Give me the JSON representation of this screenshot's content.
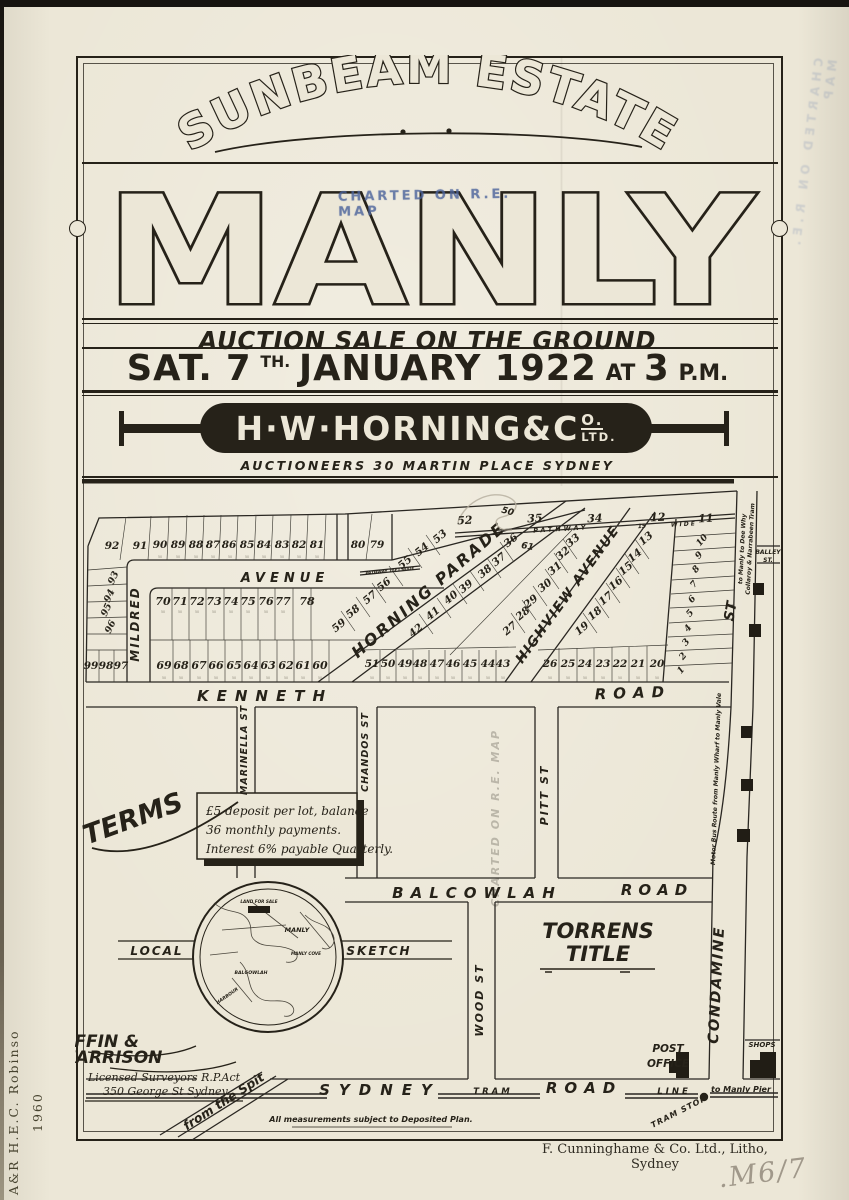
{
  "header": {
    "estate_title": "SUNBEAM ESTATE",
    "stamp": "CHARTED ON R.E. MAP",
    "place": "MANLY",
    "auction_line": "AUCTION SALE ON THE GROUND",
    "date": {
      "sat": "SAT. 7",
      "sup": "TH.",
      "rest": "JANUARY 1922",
      "at": "AT",
      "time": "3",
      "pm": "P.M."
    },
    "agent": {
      "main": "H·W·HORNING&C",
      "sup": "O.",
      "sub": "LTD.",
      "tagline": "AUCTIONEERS 30 MARTIN PLACE SYDNEY"
    }
  },
  "map": {
    "dim_label": "50",
    "lots": {
      "top_row": [
        "92",
        "91",
        "90",
        "89",
        "88",
        "87",
        "86",
        "85",
        "84",
        "83",
        "82",
        "81",
        "80",
        "79"
      ],
      "top_strip": [
        "52",
        "35",
        "34",
        "12",
        "11"
      ],
      "west_col": [
        "93",
        "94",
        "95",
        "96"
      ],
      "west_bottom": [
        "99",
        "98",
        "97"
      ],
      "mid_row_upper": [
        "70",
        "71",
        "72",
        "73",
        "74",
        "75",
        "76",
        "77",
        "78"
      ],
      "mid_row_lower": [
        "69",
        "68",
        "67",
        "66",
        "65",
        "64",
        "63",
        "62",
        "61",
        "60"
      ],
      "parade_west": [
        "53",
        "54",
        "55",
        "56",
        "57",
        "58",
        "59"
      ],
      "parade_east": [
        "36",
        "37",
        "38",
        "39",
        "40",
        "41",
        "42"
      ],
      "highview_west": [
        "33",
        "32",
        "31",
        "30",
        "29",
        "28",
        "27"
      ],
      "highview_east": [
        "13",
        "14",
        "15",
        "16",
        "17",
        "18",
        "19"
      ],
      "bottom_mid": [
        "51",
        "50",
        "49",
        "48",
        "47",
        "46",
        "45",
        "44",
        "43"
      ],
      "bottom_east": [
        "26",
        "25",
        "24",
        "23",
        "22",
        "21",
        "20"
      ],
      "east_col": [
        "10",
        "9",
        "8",
        "7",
        "6",
        "5",
        "4",
        "3",
        "2",
        "1"
      ]
    },
    "streets": {
      "mildred": "MILDRED",
      "avenue": "AVENUE",
      "horning": "HORNING PARADE",
      "highview": "HIGHVIEW AVENUE",
      "kenneth": "KENNETH",
      "kenneth_road": "ROAD",
      "pathway": "PATHWAY",
      "pathway_width": "15",
      "pathway_wide": "WIDE",
      "pathway_small": "PATHWAY 15FT WIDE",
      "st_upper": "ST",
      "balley_1": "BALLEY",
      "balley_2": "ST.",
      "marinella": "MARINELLA ST",
      "chandos": "CHANDOS ST",
      "pitt": "PITT ST",
      "wood": "WOOD ST",
      "balcowlah": "BALCOWLAH",
      "balcowlah_road": "ROAD",
      "condamine": "CONDAMINE",
      "sydney": "SYDNEY",
      "sydney_road": "ROAD",
      "tram": "TRAM",
      "line": "LINE",
      "to_manly_pier": "to Manly Pier",
      "tram_stop": "TRAM STOP",
      "from_the_spit": "from the Spit",
      "tram_route_1": "to Manly to Dee Why",
      "tram_route_2": "Collaroy & Narrabeen Tram",
      "bus_route": "Motor Bus Route from Manly Wharf to Manly Vale"
    },
    "labels": {
      "torrens_1": "TORRENS",
      "torrens_2": "TITLE",
      "post_1": "POST",
      "post_2": "OFFICE",
      "shops": "SHOPS",
      "local": "LOCAL",
      "sketch": "SKETCH",
      "note": "All measurements subject to Deposited Plan.",
      "pencil_1": "50",
      "pencil_2": "61"
    },
    "terms": {
      "title": "TERMS",
      "line1": "£5 deposit per lot, balance",
      "line2": "36 monthly payments.",
      "line3": "Interest 6% payable Quarterly."
    },
    "sketch_inset": {
      "land": "LAND FOR SALE",
      "manly": "MANLY",
      "cove": "MANLY COVE",
      "balgowlah": "BALGOWLAH",
      "harbour": "HARBOUR"
    },
    "surveyor": {
      "name1": "GRIFFIN &",
      "name2": "HARRISON",
      "line1": "Licensed Surveyors R.P.Act",
      "line2": "350 George St Sydney."
    }
  },
  "footer": {
    "printer": "F. Cunninghame & Co. Ltd., Litho, Sydney",
    "pencil_ref": ".M6/7"
  },
  "margin": {
    "stamp_left_1": "A&R H.E.C. Robinso",
    "stamp_left_2": "1960"
  },
  "colors": {
    "ink": "#262219",
    "paper": "#ece7d7",
    "stamp_blue": "#5a73a8",
    "pencil": "#a79e8e"
  }
}
